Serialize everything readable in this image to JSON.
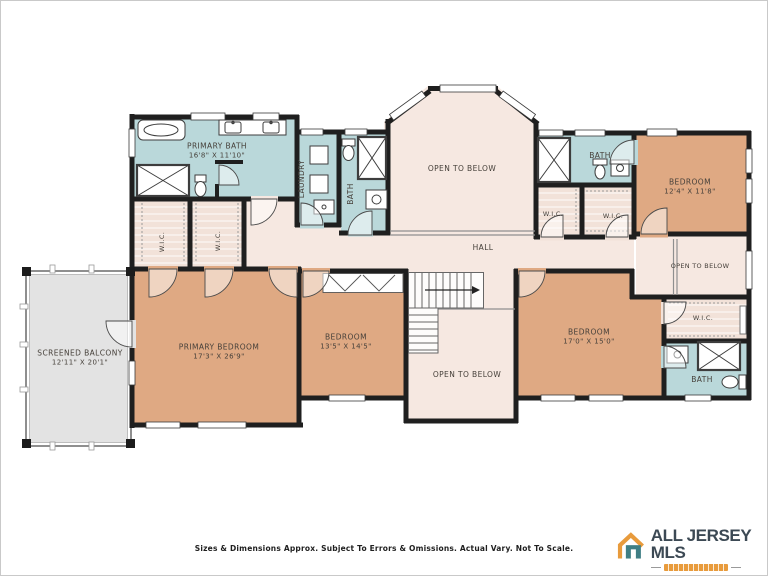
{
  "rooms": {
    "primary_bath": {
      "label": "PRIMARY BATH",
      "dims": "16'8\" X 11'10\""
    },
    "laundry": {
      "label": "LAUNDRY"
    },
    "bath_hall": {
      "label": "BATH"
    },
    "open_below_top": {
      "label": "OPEN TO BELOW"
    },
    "bath_upper_right": {
      "label": "BATH"
    },
    "wic_1": {
      "label": "W.I.C."
    },
    "wic_2": {
      "label": "W.I.C."
    },
    "bedroom_ne": {
      "label": "BEDROOM",
      "dims": "12'4\" X 11'8\""
    },
    "wic_3": {
      "label": "W.I.C."
    },
    "wic_4": {
      "label": "W.I.C."
    },
    "hall": {
      "label": "HALL"
    },
    "open_below_right": {
      "label": "OPEN TO BELOW"
    },
    "screened_balcony": {
      "label": "SCREENED BALCONY",
      "dims": "12'11\" X 20'1\""
    },
    "primary_bedroom": {
      "label": "PRIMARY BEDROOM",
      "dims": "17'3\" X 26'9\""
    },
    "bedroom_center": {
      "label": "BEDROOM",
      "dims": "13'5\" X 14'5\""
    },
    "open_below_center": {
      "label": "OPEN TO BELOW"
    },
    "bedroom_se": {
      "label": "BEDROOM",
      "dims": "17'0\" X 15'0\""
    },
    "wic_5": {
      "label": "W.I.C."
    },
    "bath_lower_right": {
      "label": "BATH"
    }
  },
  "footer": {
    "disclaimer": "Sizes & Dimensions Approx. Subject To Errors & Omissions. Actual Vary. Not To Scale."
  },
  "logo": {
    "name": "ALL JERSEY MLS"
  },
  "colors": {
    "bedroom": "#dfa983",
    "bath": "#bad8da",
    "floor": "#f6e8e1",
    "closet": "#f2e2d9",
    "balcony": "#e3e3e3",
    "wall": "#1f1f1f",
    "logo_orange": "#e89b3c",
    "logo_slate": "#3c4954"
  }
}
